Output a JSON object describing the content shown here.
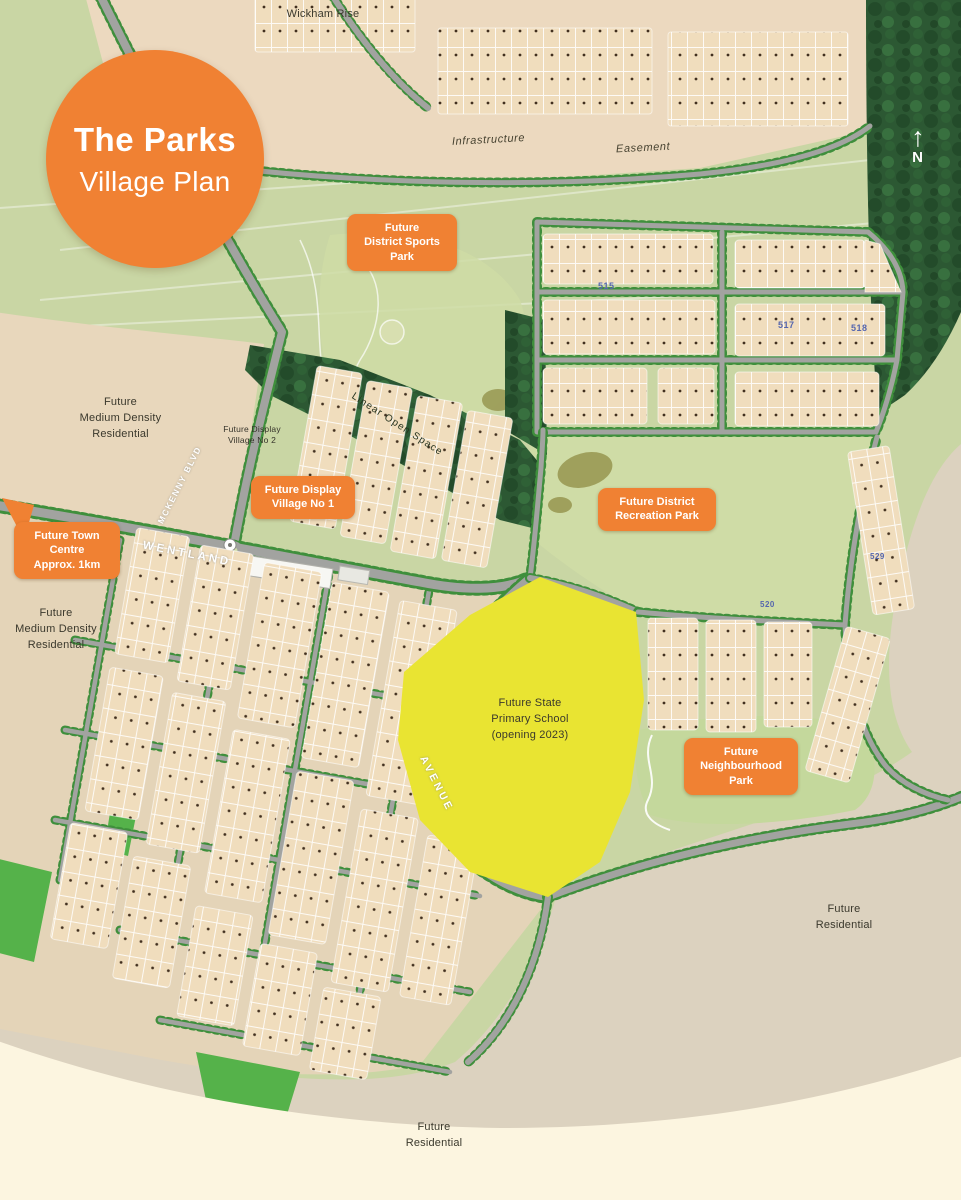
{
  "title": {
    "line1": "The Parks",
    "line2": "Village Plan"
  },
  "compass": {
    "arrow": "↑",
    "label": "N"
  },
  "top": {
    "wickham_rise": "Wickham Rise",
    "infrastructure": "Infrastructure",
    "easement": "Easement"
  },
  "badges": {
    "sports_park": "Future\nDistrict Sports\nPark",
    "display_village_1": "Future Display\nVillage No 1",
    "town_centre": "Future Town\nCentre\nApprox. 1km",
    "recreation_park": "Future District\nRecreation Park",
    "neighbourhood_park": "Future\nNeighbourhood\nPark"
  },
  "areas": {
    "medium_density_1": "Future\nMedium Density\nResidential",
    "display_village_2": "Future Display\nVillage No 2",
    "medium_density_2": "Future\nMedium Density\nResidential",
    "school": "Future State\nPrimary School\n(opening 2023)",
    "residential_east": "Future\nResidential",
    "residential_south": "Future\nResidential",
    "linear_open_space": "Linear Open Space"
  },
  "roads": {
    "wentland": "WENTLAND",
    "avenue": "AVENUE",
    "mckenny": "MCKENNY BLVD"
  },
  "stages": [
    "515",
    "517",
    "518",
    "520",
    "529"
  ],
  "colors": {
    "accent_orange": "#F08133",
    "school_yellow": "#E9E432",
    "stage_blue": "#5566AE",
    "map_green": "#C9D6A4",
    "forest_green": "#2C5833",
    "lot_beige": "#F0DDBD",
    "road_grey": "#A2A3A0",
    "cream": "#FCF5E0"
  }
}
